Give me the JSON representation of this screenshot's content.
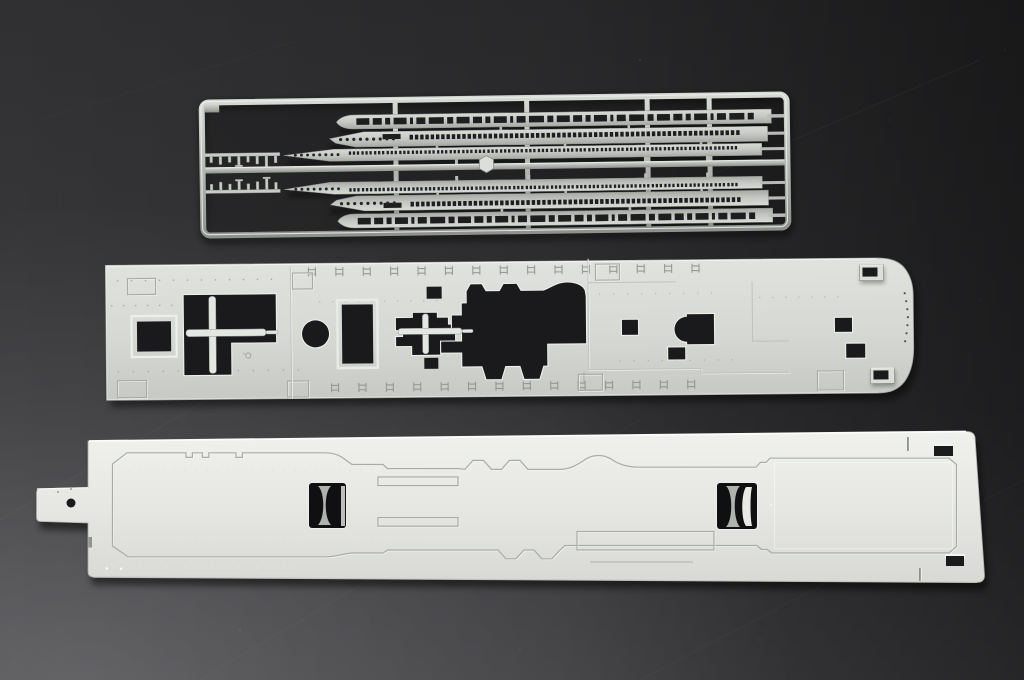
{
  "scene": {
    "description": "Photograph of light-grey injection-molded plastic model kit pieces laid on a dark studio backdrop: one sprue of ship superstructure wall strips with rows of windows, a long upper deck panel with many openings, and a large hangar deck panel with two elevator wells",
    "background": {
      "top": "#303032",
      "bottom": "#4c4c4f"
    }
  },
  "palette": {
    "backdrop_top": "#303032",
    "backdrop_bottom": "#4c4c4f",
    "sprue_plastic": "#c6c8c4",
    "raised_plastic": "#dcdeda",
    "deck_upper_plastic": "#d6d8d4",
    "deck_lower_plastic": "#e9eae6",
    "hole_dark": "#1a1a1d",
    "window_dark": "#1e1e21",
    "rod_plastic": "#e4e6e2",
    "well_wall": "#b0b2ae",
    "highlight": "#f4f6f2",
    "engraving": "#a9aba7"
  },
  "parts": {
    "sprue": {
      "label": "sprue-superstructure-wall-strips",
      "strip_count": 6,
      "small_part_count": 3
    },
    "upper_deck": {
      "label": "upper-deck-panel",
      "opening_count": 14
    },
    "lower_deck": {
      "label": "hangar-deck-panel",
      "elevator_well_count": 2
    }
  },
  "generators": {
    "winA": {
      "kind": "window-row",
      "x0": 357,
      "xmax": 756,
      "y": 116.4,
      "h": 6.6,
      "gap": 3.4,
      "widths": [
        13,
        9,
        5,
        13,
        3,
        9,
        15,
        6
      ],
      "fill": "#1e1e21"
    },
    "winB": {
      "kind": "window-groups",
      "x0": 410,
      "xmax": 752,
      "y": 133.6,
      "n": 3,
      "w": 3.4,
      "h": 4.8,
      "gapIn": 1.9,
      "pitch": 15.8,
      "fill": "#1e1e21"
    },
    "portB": {
      "kind": "circle-row",
      "x0": 341,
      "cy": 137.4,
      "r": 1.6,
      "pitch": 6.6,
      "count": 9,
      "fill": "#26262a"
    },
    "dashC": {
      "kind": "window-groups",
      "x0": 349,
      "xmax": 748,
      "y": 149.4,
      "n": 3,
      "w": 2.3,
      "h": 3.4,
      "gapIn": 1.7,
      "pitch": 12.6,
      "fill": "#222226"
    },
    "portC": {
      "kind": "circle-row",
      "x0": 295.5,
      "cy": 152.4,
      "r": 1.45,
      "pitch": 6.1,
      "count": 8,
      "fill": "#26262a"
    },
    "ticksTop": {
      "kind": "tick-row",
      "x0": 309,
      "y": 265.5,
      "pitch": 27.4,
      "count": 15,
      "w": 7,
      "h": 9,
      "stroke": "#8f918d"
    },
    "ticksBottom": {
      "kind": "tick-row",
      "x0": 331,
      "y": 381.5,
      "pitch": 27.4,
      "count": 14,
      "w": 7,
      "h": 9,
      "stroke": "#8f918d"
    },
    "dotsMid": {
      "kind": "dot-lines",
      "lines": [
        {
          "x0": 118,
          "x1": 282,
          "y": 277,
          "pitch": 14,
          "r": 0.8,
          "fill": "#7a7c78",
          "opacity": 0.55
        },
        {
          "x0": 112,
          "x1": 175,
          "y": 302,
          "pitch": 12,
          "r": 0.8,
          "fill": "#7a7c78",
          "opacity": 0.5
        },
        {
          "x0": 118,
          "x1": 300,
          "y": 368,
          "pitch": 15,
          "r": 0.8,
          "fill": "#7a7c78",
          "opacity": 0.45
        },
        {
          "x0": 320,
          "x1": 440,
          "y": 300,
          "pitch": 13,
          "r": 0.7,
          "fill": "#7a7c78",
          "opacity": 0.4
        },
        {
          "x0": 600,
          "x1": 720,
          "y": 295,
          "pitch": 14,
          "r": 0.7,
          "fill": "#7a7c78",
          "opacity": 0.4
        },
        {
          "x0": 760,
          "x1": 840,
          "y": 300,
          "pitch": 13,
          "r": 0.7,
          "fill": "#7a7c78",
          "opacity": 0.4
        },
        {
          "x0": 620,
          "x1": 740,
          "y": 362,
          "pitch": 14,
          "r": 0.7,
          "fill": "#7a7c78",
          "opacity": 0.4
        },
        {
          "x0": 110,
          "x1": 640,
          "y": 262,
          "pitch": 9,
          "r": 0.6,
          "fill": "#f2f4f0",
          "opacity": 0.3
        },
        {
          "x0": 340,
          "x1": 700,
          "y": 392.5,
          "pitch": 9,
          "r": 0.6,
          "fill": "#f2f4f0",
          "opacity": 0.28
        }
      ]
    },
    "dotsLow": {
      "kind": "dot-lines",
      "lines": [
        {
          "x0": 100,
          "x1": 950,
          "y": 444,
          "pitch": 9,
          "r": 0.65,
          "fill": "#fbfcf8",
          "opacity": 0.38
        },
        {
          "x0": 95,
          "x1": 300,
          "y": 568,
          "pitch": 9,
          "r": 0.7,
          "fill": "#fbfcf8",
          "opacity": 0.45
        },
        {
          "x0": 300,
          "x1": 965,
          "y": 571,
          "pitch": 9,
          "r": 0.65,
          "fill": "#fbfcf8",
          "opacity": 0.32
        },
        {
          "x0": 130,
          "x1": 420,
          "y": 470,
          "pitch": 11,
          "r": 0.6,
          "fill": "#c9cbc7",
          "opacity": 0.5
        },
        {
          "x0": 480,
          "x1": 760,
          "y": 472,
          "pitch": 11,
          "r": 0.6,
          "fill": "#c9cbc7",
          "opacity": 0.4
        },
        {
          "x0": 130,
          "x1": 420,
          "y": 540,
          "pitch": 11,
          "r": 0.6,
          "fill": "#c9cbc7",
          "opacity": 0.4
        }
      ]
    }
  }
}
